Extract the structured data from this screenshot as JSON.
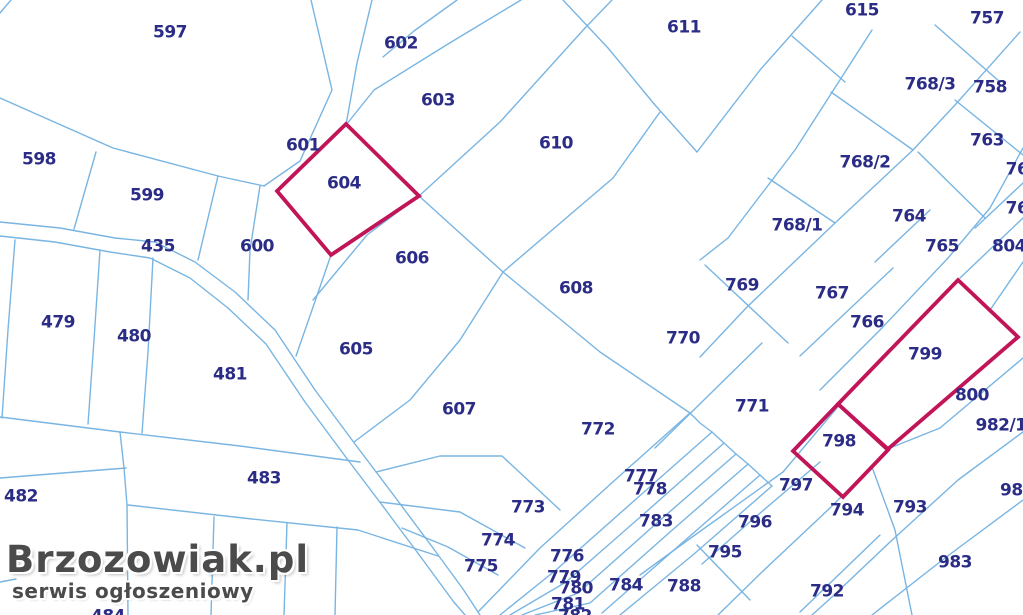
{
  "map": {
    "type": "cadastral-parcel-map",
    "background_color": "#ffffff",
    "line_color": "#79b5e2",
    "label_color": "#2b2c85",
    "highlight_color": "#c11558",
    "highlighted_parcels": [
      "604",
      "799",
      "798"
    ],
    "road_parcel": "435",
    "parcels": [
      {
        "label": "597",
        "x": 170,
        "y": 33
      },
      {
        "label": "602",
        "x": 401,
        "y": 44
      },
      {
        "label": "611",
        "x": 684,
        "y": 28
      },
      {
        "label": "615",
        "x": 862,
        "y": 11
      },
      {
        "label": "757",
        "x": 987,
        "y": 19
      },
      {
        "label": "603",
        "x": 438,
        "y": 101
      },
      {
        "label": "768/3",
        "x": 930,
        "y": 85
      },
      {
        "label": "758",
        "x": 990,
        "y": 88
      },
      {
        "label": "610",
        "x": 556,
        "y": 144
      },
      {
        "label": "601",
        "x": 303,
        "y": 146
      },
      {
        "label": "763",
        "x": 987,
        "y": 141
      },
      {
        "label": "598",
        "x": 39,
        "y": 160
      },
      {
        "label": "768/2",
        "x": 865,
        "y": 163
      },
      {
        "label": "76",
        "x": 1017,
        "y": 170
      },
      {
        "label": "604",
        "x": 344,
        "y": 184
      },
      {
        "label": "599",
        "x": 147,
        "y": 196
      },
      {
        "label": "764",
        "x": 909,
        "y": 217
      },
      {
        "label": "76",
        "x": 1017,
        "y": 209
      },
      {
        "label": "768/1",
        "x": 797,
        "y": 226
      },
      {
        "label": "435",
        "x": 158,
        "y": 247
      },
      {
        "label": "600",
        "x": 257,
        "y": 247
      },
      {
        "label": "765",
        "x": 942,
        "y": 247
      },
      {
        "label": "804",
        "x": 1009,
        "y": 247
      },
      {
        "label": "606",
        "x": 412,
        "y": 259
      },
      {
        "label": "769",
        "x": 742,
        "y": 286
      },
      {
        "label": "608",
        "x": 576,
        "y": 289
      },
      {
        "label": "767",
        "x": 832,
        "y": 294
      },
      {
        "label": "479",
        "x": 58,
        "y": 323
      },
      {
        "label": "766",
        "x": 867,
        "y": 323
      },
      {
        "label": "480",
        "x": 134,
        "y": 337
      },
      {
        "label": "770",
        "x": 683,
        "y": 339
      },
      {
        "label": "605",
        "x": 356,
        "y": 350
      },
      {
        "label": "799",
        "x": 925,
        "y": 355
      },
      {
        "label": "481",
        "x": 230,
        "y": 375
      },
      {
        "label": "800",
        "x": 972,
        "y": 396
      },
      {
        "label": "771",
        "x": 752,
        "y": 407
      },
      {
        "label": "607",
        "x": 459,
        "y": 410
      },
      {
        "label": "982/1",
        "x": 1001,
        "y": 426
      },
      {
        "label": "772",
        "x": 598,
        "y": 430
      },
      {
        "label": "798",
        "x": 839,
        "y": 442
      },
      {
        "label": "777",
        "x": 641,
        "y": 477
      },
      {
        "label": "483",
        "x": 264,
        "y": 479
      },
      {
        "label": "797",
        "x": 796,
        "y": 486
      },
      {
        "label": "778",
        "x": 650,
        "y": 490
      },
      {
        "label": "982",
        "x": 1017,
        "y": 491
      },
      {
        "label": "482",
        "x": 21,
        "y": 497
      },
      {
        "label": "773",
        "x": 528,
        "y": 508
      },
      {
        "label": "793",
        "x": 910,
        "y": 508
      },
      {
        "label": "794",
        "x": 847,
        "y": 511
      },
      {
        "label": "783",
        "x": 656,
        "y": 522
      },
      {
        "label": "796",
        "x": 755,
        "y": 523
      },
      {
        "label": "774",
        "x": 498,
        "y": 541
      },
      {
        "label": "795",
        "x": 725,
        "y": 553
      },
      {
        "label": "776",
        "x": 567,
        "y": 557
      },
      {
        "label": "983",
        "x": 955,
        "y": 563
      },
      {
        "label": "775",
        "x": 481,
        "y": 567
      },
      {
        "label": "779",
        "x": 564,
        "y": 578
      },
      {
        "label": "784",
        "x": 626,
        "y": 586
      },
      {
        "label": "788",
        "x": 684,
        "y": 587
      },
      {
        "label": "780",
        "x": 576,
        "y": 589
      },
      {
        "label": "792",
        "x": 827,
        "y": 592
      },
      {
        "label": "781",
        "x": 568,
        "y": 605
      },
      {
        "label": "782",
        "x": 575,
        "y": 617
      },
      {
        "label": "484",
        "x": 108,
        "y": 617
      }
    ]
  },
  "watermark": {
    "title": "Brzozowiak.pl",
    "subtitle": "serwis ogłoszeniowy"
  }
}
